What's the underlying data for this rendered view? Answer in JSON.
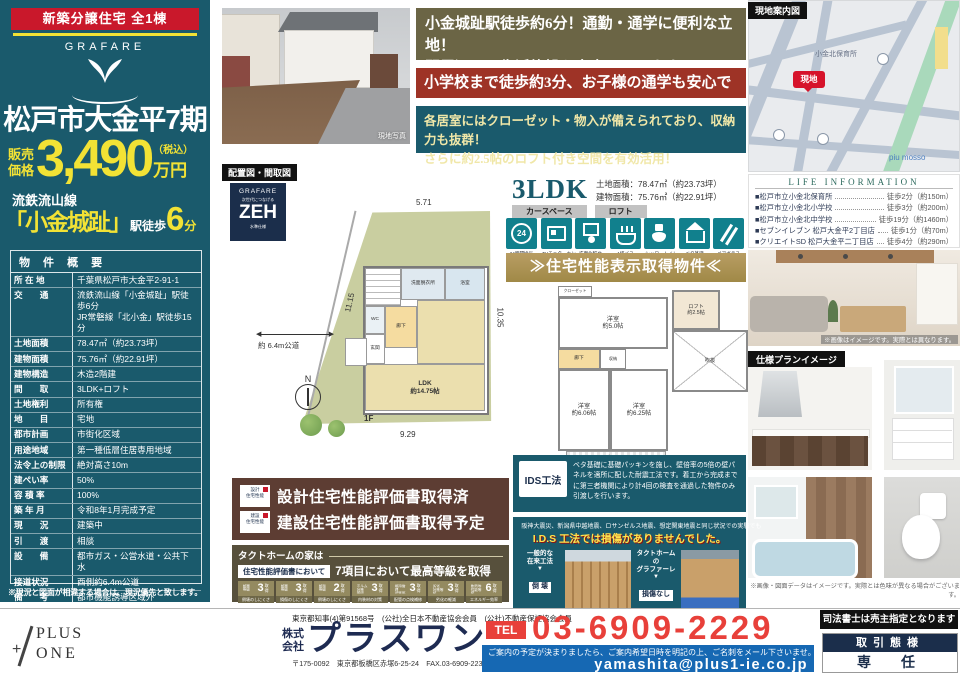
{
  "left_panel": {
    "badge": "新築分譲住宅 全1棟",
    "brand": "GRAFARE",
    "title": "松戸市大金平7期",
    "price_prefix": "販売\n価格",
    "price_value": "3,490",
    "price_tax": "（税込）",
    "price_unit": "万円",
    "line_name": "流鉄流山線",
    "station_name": "「小金城趾」",
    "walk_label": "駅徒歩",
    "walk_minutes": "6",
    "walk_unit": "分",
    "overview_title": "物 件 概 要",
    "rows": [
      {
        "label": "所 在 地",
        "value": "千葉県松戸市大金平2-91-1"
      },
      {
        "label": "交　　通",
        "value": "流鉄流山線「小金城趾」駅徒歩6分\nJR常磐線「北小金」駅徒歩15分"
      },
      {
        "label": "土地面積",
        "value": "78.47㎡（約23.73坪）"
      },
      {
        "label": "建物面積",
        "value": "75.76㎡（約22.91坪）"
      },
      {
        "label": "建物構造",
        "value": "木造2階建"
      },
      {
        "label": "間　　取",
        "value": "3LDK+ロフト"
      },
      {
        "label": "土地権利",
        "value": "所有権"
      },
      {
        "label": "地　　目",
        "value": "宅地"
      },
      {
        "label": "都市計画",
        "value": "市街化区域"
      },
      {
        "label": "用途地域",
        "value": "第一種低層住居専用地域"
      },
      {
        "label": "法令上の制限",
        "value": "絶対高さ10m"
      },
      {
        "label": "建ぺい率",
        "value": "50%"
      },
      {
        "label": "容 積 率",
        "value": "100%"
      },
      {
        "label": "築 年 月",
        "value": "令和8年1月完成予定"
      },
      {
        "label": "現　　況",
        "value": "建築中"
      },
      {
        "label": "引　　渡",
        "value": "相談"
      },
      {
        "label": "設　　備",
        "value": "都市ガス・公営水道・公共下水"
      },
      {
        "label": "接道状況",
        "value": "西側約6.4m公道"
      },
      {
        "label": "備　　考",
        "value": "都市機能誘導区域外\n居住誘導区域内"
      }
    ],
    "note": "※現況と図面が相違する場合は、現況優先と致します。"
  },
  "photo": {
    "caption": "現地写真"
  },
  "banners": {
    "b1_line1": "小金城趾駅徒歩約6分！通勤・通学に便利な立地！",
    "b1_line2": "駅周辺には生活施設も充実しています。",
    "b2": "小学校まで徒歩約3分、お子様の通学も安心です。",
    "b3_line1": "各居室にはクローゼット・物入が備えられており、収納力も抜群！",
    "b3_line2": "さらに約2.5帖のロフト付き空間を有効活用！"
  },
  "map": {
    "label": "現地案内図",
    "pin": "現地",
    "poi1": "小金北保育所",
    "poi2": "piu mosso"
  },
  "life_info": {
    "title": "LIFE INFORMATION",
    "items": [
      {
        "name": "■松戸市立小金北保育所",
        "dist": "徒歩2分（約150m）"
      },
      {
        "name": "■松戸市立小金北小学校",
        "dist": "徒歩3分（約200m）"
      },
      {
        "name": "■松戸市立小金北中学校",
        "dist": "徒歩19分（約1460m）"
      },
      {
        "name": "■セブンイレブン 松戸大金平2丁目店",
        "dist": "徒歩1分（約70m）"
      },
      {
        "name": "■クリエイトSD 松戸大金平二丁目店",
        "dist": "徒歩4分（約290m）"
      }
    ]
  },
  "plan": {
    "section_label": "配置図・間取図",
    "zeh_brand": "GRAFARE",
    "zeh_top": "次世代につなげる",
    "zeh_main": "ZEH",
    "zeh_bottom": "水準仕様",
    "dim_top": "5.71",
    "dim_left": "11.15",
    "dim_right": "10.35",
    "dim_bottom": "9.29",
    "road_label": "約 6.4m公道",
    "compass": "N",
    "floor1": "1F",
    "floor2": "2F",
    "ldk": "LDK\n約14.75帖",
    "entrance": "玄関",
    "hall": "廊下",
    "wc": "WC",
    "wash": "洗面脱衣所",
    "bath": "浴室",
    "room1": "洋室\n約5.0帖",
    "room2": "洋室\n約6.06帖",
    "room3": "洋室\n約6.25帖",
    "closet": "クローゼット",
    "storage": "収納",
    "balcony": "バルコニー",
    "loft": "ロフト\n約2.5帖",
    "void": "吹抜"
  },
  "spec": {
    "type": "3LDK",
    "land_area": "土地面積：78.47㎡（約23.73坪）",
    "building_area": "建物面積：75.76㎡（約22.91坪）",
    "tag1": "カースペース",
    "tag2": "ロフト",
    "icons": [
      {
        "label": "24時間換気"
      },
      {
        "label": "TVモニターホン"
      },
      {
        "label": "洗面化粧台"
      },
      {
        "label": "1坪バス"
      },
      {
        "label": "シャワートイレ"
      },
      {
        "label": "ベタ基礎"
      },
      {
        "label": "ペアガラス"
      }
    ],
    "gold_banner": "≫住宅性能表示取得物件≪"
  },
  "performance": {
    "badge1": "設計\n住宅性能",
    "row1": "設計住宅性能評価書取得済",
    "badge2": "建設\n住宅性能",
    "row2": "建設住宅性能評価書取得予定"
  },
  "tact": {
    "header": "タクトホームの家は",
    "sub_label": "住宅性能評価書において",
    "sub_text": "7項目において最高等級を取得",
    "grades": [
      {
        "name": "耐震\n等級",
        "num": "3",
        "suf": "取得",
        "desc": "倒壊のしにくさ"
      },
      {
        "name": "耐震\n等級",
        "num": "3",
        "suf": "取得",
        "desc": "損傷のしにくさ"
      },
      {
        "name": "耐風\n等級",
        "num": "2",
        "suf": "取得",
        "desc": "倒壊のしにくさ"
      },
      {
        "name": "ホルム対策\n等級",
        "num": "3",
        "suf": "取得",
        "desc": "内装材の対策"
      },
      {
        "name": "維持管理\n対策等級",
        "num": "3",
        "suf": "取得",
        "desc": "配管の点検補修"
      },
      {
        "name": "劣化\n対策等級",
        "num": "3",
        "suf": "取得",
        "desc": "劣化の軽減"
      },
      {
        "name": "断熱等\n性能等級",
        "num": "6",
        "suf": "取得",
        "desc": "エネルギー効率"
      }
    ]
  },
  "ids": {
    "logo": "IDS工法",
    "desc": "ベタ基礎に基礎パッキンを施し、壁倍率の5倍の壁パネルを適所に配した耐震工法です。着工から完成までに第三者機関により計4回の検査を通過した物件のみ引渡しを行います。",
    "quake_line": "阪神大震災、新潟県中越地震、ロサンゼルス地震、想定関東地震と同じ状況での実験でも",
    "quake_highlight": "I.D.S 工法では損傷がありませんでした。",
    "left_caption": "一般的な\n在来工法",
    "left_arrow": "▼",
    "left_result": "倒 壊",
    "right_caption": "タクトホームの\nグラファーレ",
    "right_arrow": "▼",
    "right_result": "損傷なし"
  },
  "gallery": {
    "living_caption": "※画像はイメージです。実際とは異なります。",
    "spec_label": "仕様プランイメージ",
    "bottom_caption": "※画像・図面データはイメージです。実際とは色味が異なる場合がございます。"
  },
  "footer": {
    "license": "東京都知事(4)第91568号　(公社)全日本不動産協会会員　(公社)不動産保証協会会員",
    "logo_top": "PLUS",
    "logo_plus": "+",
    "logo_bottom": "ONE",
    "company_prefix": "株式\n会社",
    "company_name": "プラスワン",
    "address": "〒175-0092　東京都板橋区赤塚6-25-24　FAX.03-6909-2239　HP http://www.plus1-ie.co.jp/",
    "tel_label": "TEL",
    "tel_number": "03-6909-2229",
    "mail_note": "ご案内の予定が決まりましたら、ご案内希望日時を明記の上、ご名刺をメール下さいませ。",
    "email": "yamashita@plus1-ie.co.jp",
    "judicial": "司法書士は売主指定となります",
    "deal_label": "取引態様",
    "deal_value": "専　任"
  },
  "colors": {
    "teal": "#1A5A6C",
    "yellow": "#F2E235",
    "red_badge": "#C9182B",
    "olive_banner": "#6B6545",
    "brick_banner": "#9E3326",
    "gold_banner": "#AE9156",
    "brown_box": "#5D3D33",
    "tact_box": "#57503C",
    "navy": "#1B2E4B",
    "phone_red": "#E8403A",
    "email_blue": "#1668B3"
  }
}
